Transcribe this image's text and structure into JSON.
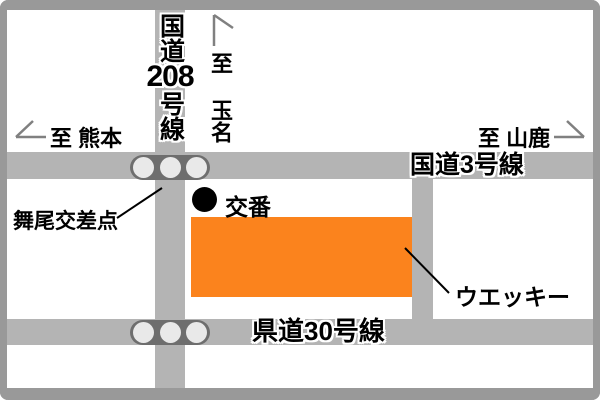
{
  "map": {
    "roads": {
      "route208": {
        "label_top": "国道",
        "label_num": "208",
        "label_bottom": "号線"
      },
      "route3": {
        "label": "国道3号線"
      },
      "route30": {
        "label": "県道30号線"
      },
      "side_road": {
        "label": ""
      }
    },
    "directions": {
      "kumamoto": {
        "label": "至 熊本",
        "arrow": "left"
      },
      "tamana": {
        "label": "至 玉名",
        "arrow": "up"
      },
      "yamaga": {
        "label": "至 山鹿",
        "arrow": "right"
      }
    },
    "landmarks": {
      "maio_intersection": {
        "label": "舞尾交差点"
      },
      "koban": {
        "label": "交番"
      },
      "uekky": {
        "label": "ウエッキー"
      }
    },
    "colors": {
      "road": "#b4b4b4",
      "frame": "#999999",
      "building": "#fb831d",
      "signal_body": "#6e6e6e",
      "signal_lamp": "#e9e9e9",
      "text": "#000000"
    }
  }
}
